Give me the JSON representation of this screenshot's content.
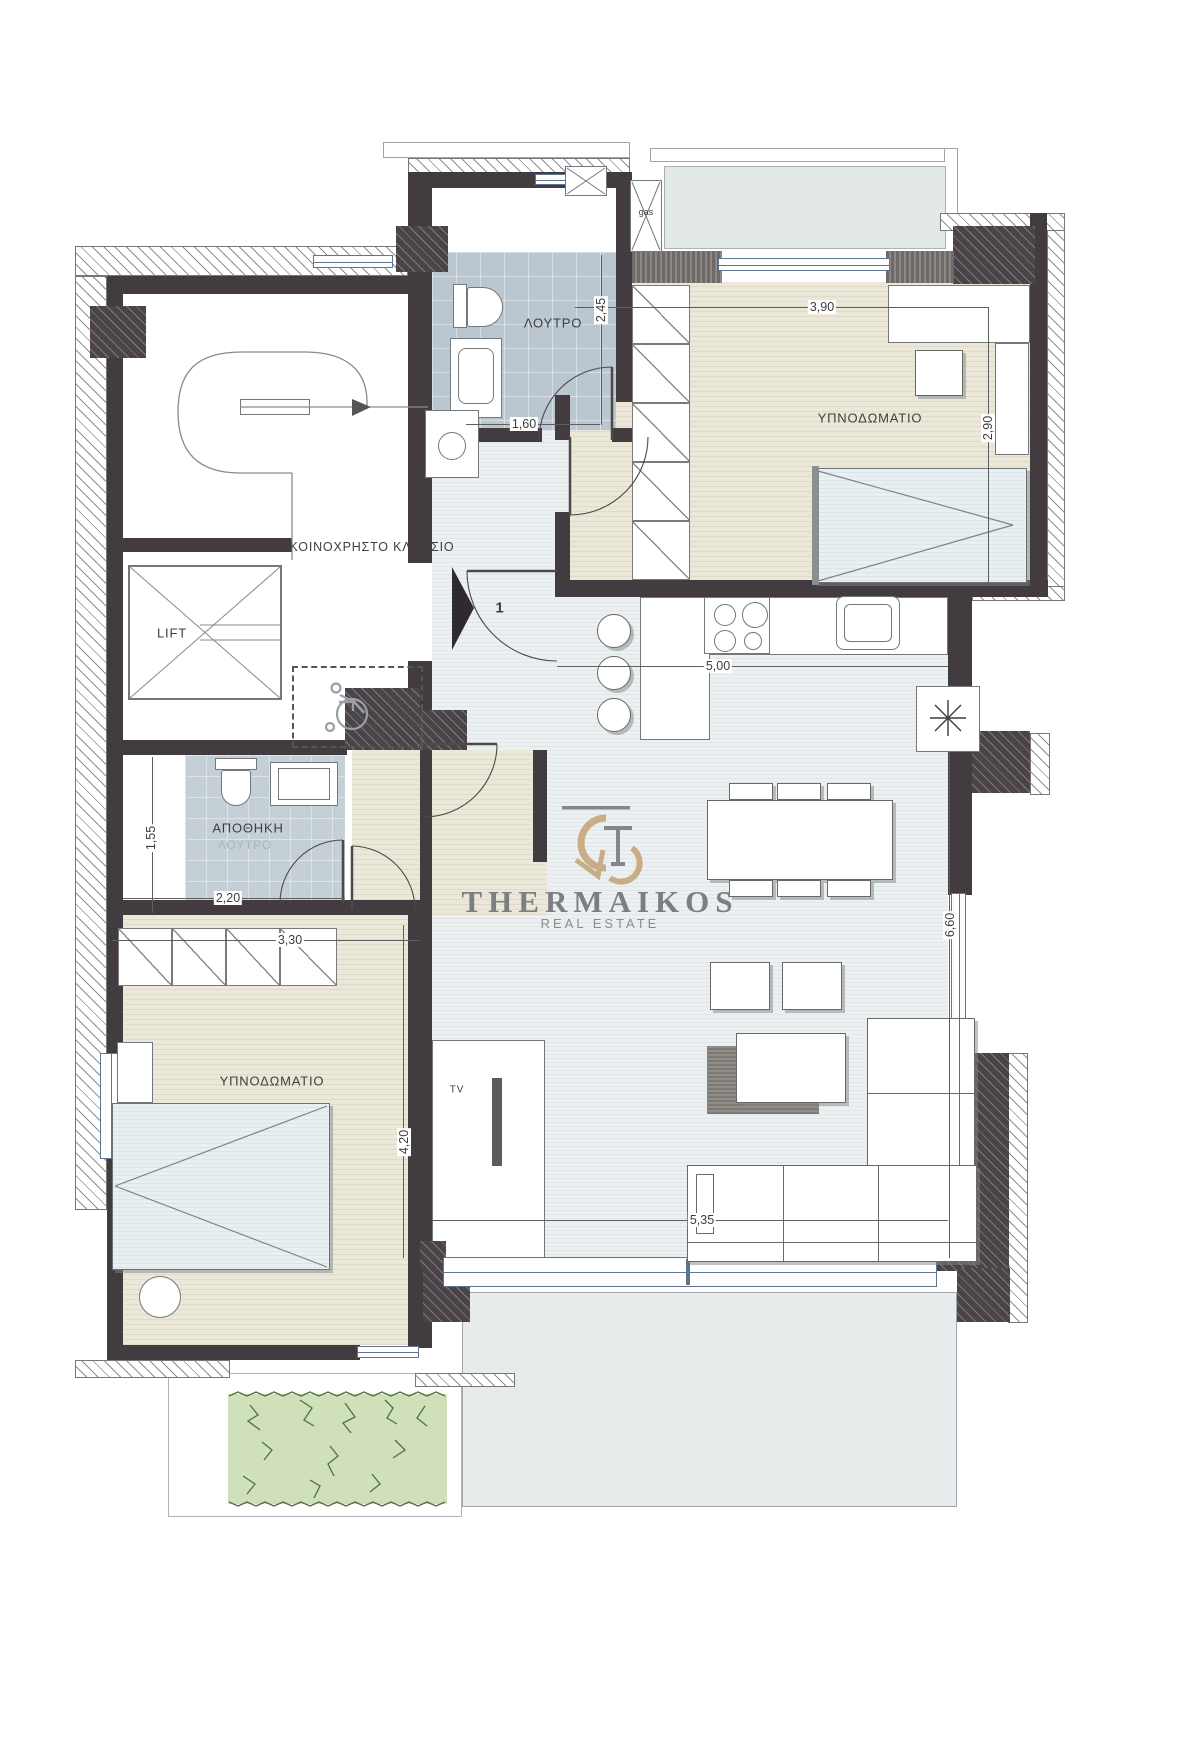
{
  "labels": {
    "stairwell": "ΚΟΙΝΟΧΡΗΣΤΟ ΚΛΙΜ/ΣΙΟ",
    "lift": "LIFT",
    "bathroom_top": "ΛΟΥΤΡΟ",
    "bedroom_right": "ΥΠΝΟΔΩΜΑΤΙΟ",
    "bedroom_left": "ΥΠΝΟΔΩΜΑΤΙΟ",
    "storage": "ΑΠΟΘΗΚΗ",
    "storage_former": "ΛΟΥΤΡΟ",
    "gas_shaft": "gas",
    "tv": "TV",
    "entrance_number": "1"
  },
  "dimensions": {
    "bathroom_height": "2,45",
    "bathroom_width": "1,60",
    "bedroom_right_width": "3,90",
    "bedroom_right_height": "2,90",
    "kitchen_width": "5,00",
    "storage_height": "1,55",
    "storage_width": "2,20",
    "closet_row_width": "3,30",
    "bedroom_left_height": "4,20",
    "living_height": "6,60",
    "living_width": "5,35"
  },
  "logo": {
    "brand": "THERMAIKOS",
    "tagline": "REAL ESTATE"
  },
  "icons": {
    "wheelchair_icon": "accessible-turning-area symbol",
    "stair_direction_icon": "curved stair arrow",
    "entrance_arrow_icon": "right-pointing entrance triangle",
    "heater_icon": "asterisk star",
    "lift_icon": "crossed-diagonals box",
    "gas_shaft_icon": "crossed box"
  },
  "colors": {
    "wall": "#423c40",
    "hatch_dark": "#4a4448",
    "floor_living": "#e7ebee",
    "floor_bedroom": "#e8e5d5",
    "tile_bathroom": "#bac7d0",
    "tile_storage": "#c4cfd6",
    "balcony": "#e3e8e9",
    "terrace": "#e8ebec",
    "garden": "#cfe0ba",
    "logo_gold": "#c5a97d",
    "logo_gray": "#7b7f82",
    "dimension_text": "#3d3d3d"
  }
}
